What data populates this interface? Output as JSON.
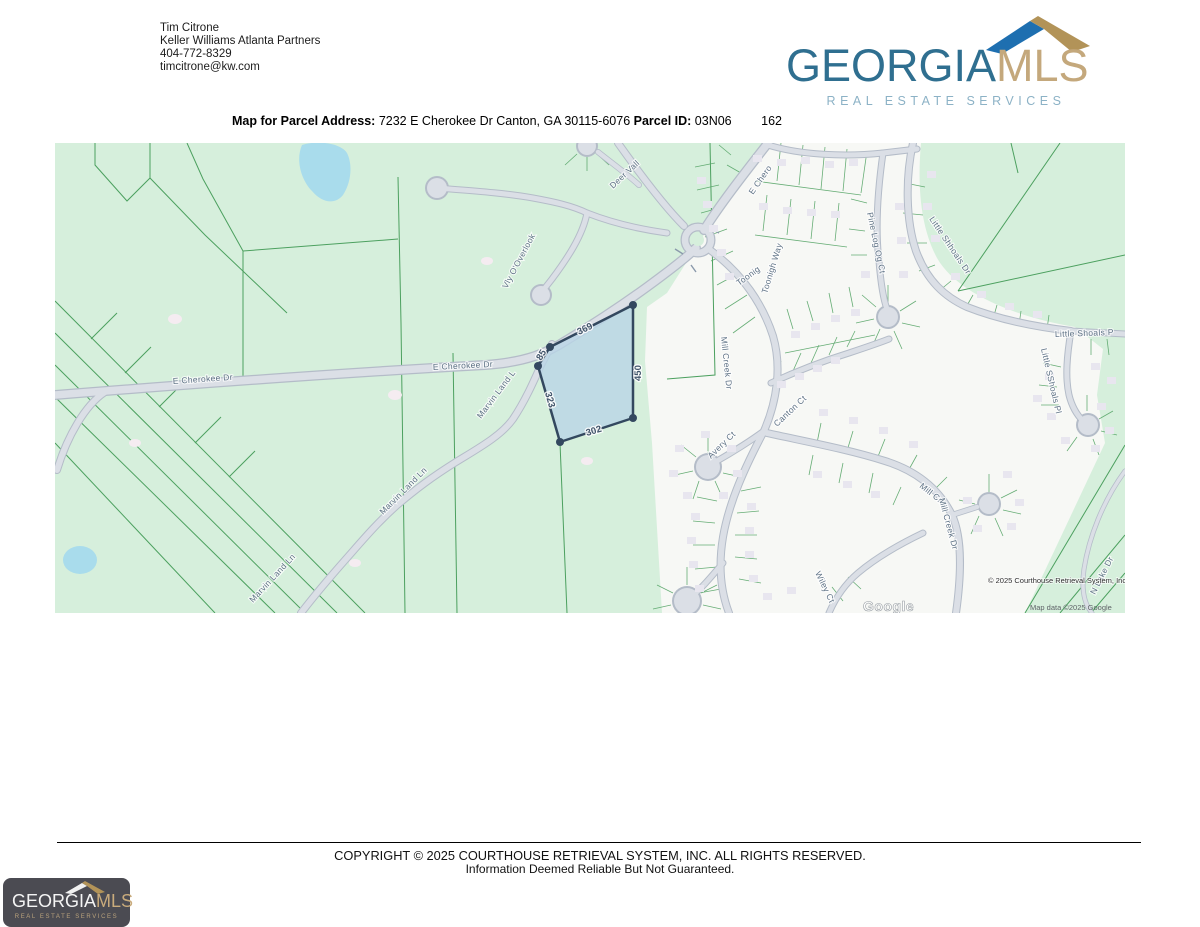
{
  "header": {
    "contact": {
      "name": "Tim Citrone",
      "company": "Keller Williams Atlanta Partners",
      "phone": "404-772-8329",
      "email": "timcitrone@kw.com"
    },
    "brand": {
      "name_primary": "GEORGIA",
      "name_secondary": "MLS",
      "tagline": "REAL ESTATE SERVICES",
      "color_primary": "#2f6f90",
      "color_secondary": "#c4a87c",
      "color_tagline": "#8cb2c6",
      "roof_blue": "#1e6fb0",
      "roof_tan": "#b29358"
    }
  },
  "title_bar": {
    "label_address": "Map for Parcel Address:",
    "address_value": "7232 E Cherokee Dr Canton, GA 30115-6076",
    "label_parcel_id": "Parcel ID:",
    "parcel_id": "03N06",
    "parcel_number": "162"
  },
  "map": {
    "parcel_edge_labels": {
      "top": "369",
      "right": "450",
      "bottom": "302",
      "left": "323",
      "upper_left": "85"
    },
    "street_labels": [
      "E Cherokee Dr",
      "E Cherokee Dr",
      "E Chero",
      "Deer Vall",
      "Vly O'Overlook",
      "Toonig",
      "Toonigh Way",
      "Pine Log Og Ct",
      "Mill Creek Dr",
      "Avery Ct",
      "Canton Ct",
      "Wiley Ct",
      "Mill Cr.",
      "Mill Creek Dr",
      "Little Shhoals Dr",
      "Little Shoals P",
      "Little SShoals Pl",
      "N Lake Dr",
      "Marvin Land Ln",
      "Marvin Land Ln",
      "Marvin Land L"
    ],
    "attribution_primary": "© 2025 Courthouse Retrieval System, Inc.",
    "attribution_map_data": "Map data ©2025 Google",
    "google_watermark": "Google",
    "colors": {
      "land_green": "#d6efdc",
      "subdivision_white": "#f7f8f5",
      "water_blue": "#a9dcec",
      "road_fill": "#dbdfe6",
      "road_casing": "#b4bcc8",
      "lot_line_green": "#57a568",
      "parcel_fill": "#b9d4e6",
      "parcel_stroke": "#33485f",
      "street_label": "#5e7285"
    }
  },
  "footer": {
    "rights": "COPYRIGHT © 2025 COURTHOUSE RETRIEVAL SYSTEM, INC. ALL RIGHTS RESERVED.",
    "disclaimer": "Information Deemed Reliable But Not Guaranteed.",
    "brand": {
      "name_primary": "GEORGIA",
      "name_secondary": "MLS",
      "tagline": "REAL ESTATE SERVICES"
    }
  }
}
